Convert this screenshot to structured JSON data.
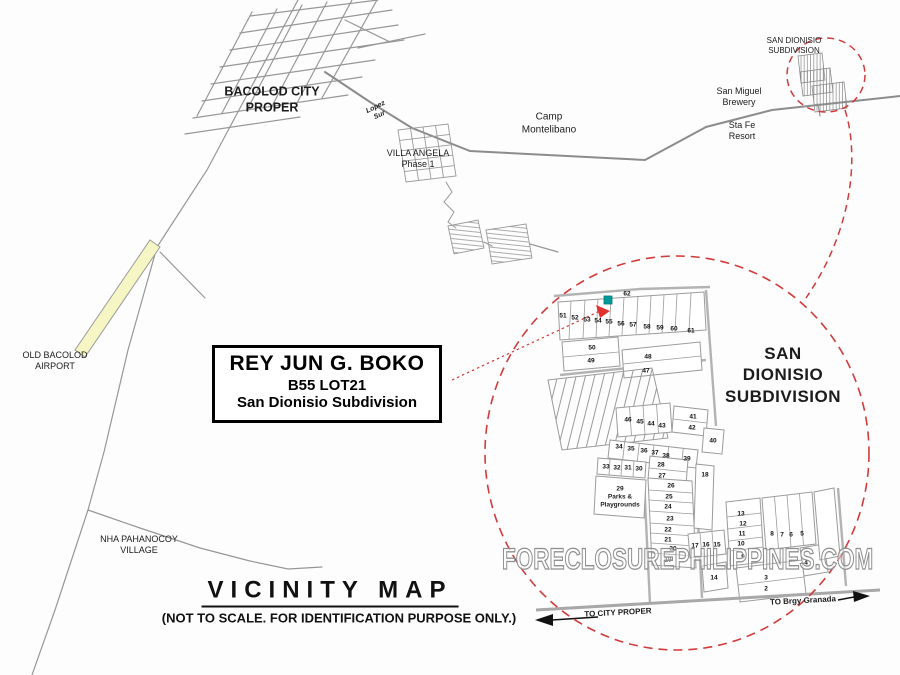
{
  "map": {
    "title": "VICINITY MAP",
    "subtitle": "(NOT TO SCALE. FOR IDENTIFICATION PURPOSE ONLY.)",
    "watermark": "FORECLOSUREPHILIPPINES.COM",
    "property_box": {
      "owner": "REY JUN G. BOKO",
      "lot": "B55 LOT21",
      "subdivision": "San Dionisio Subdivision"
    },
    "places": {
      "bacolod_city": "BACOLOD CITY\nPROPER",
      "lopez_sur": "Lopez\nSur",
      "villa_angela": "VILLA ANGELA\nPhase 1",
      "camp_montelibano": "Camp\nMontelibano",
      "san_dionisio_small": "SAN DIONISIO\nSUBDIVISION",
      "san_miguel_brewery": "San Miguel\nBrewery",
      "sta_fe_resort": "Sta Fe\nResort",
      "old_bacolod_airport": "OLD BACOLOD\nAIRPORT",
      "nha_pahanocoy": "NHA PAHANOCOY\nVILLAGE",
      "san_dionisio_big": "SAN DIONISIO\nSUBDIVISION"
    },
    "directions": {
      "to_city_proper": "TO CITY PROPER",
      "to_brgy_granada": "TO Brgy Granada"
    },
    "detail": {
      "parks_block": "29\nParks &\nPlaygrounds",
      "lots": [
        {
          "n": "51",
          "x": 563,
          "y": 316
        },
        {
          "n": "52",
          "x": 575,
          "y": 318
        },
        {
          "n": "53",
          "x": 587,
          "y": 320
        },
        {
          "n": "54",
          "x": 598,
          "y": 321
        },
        {
          "n": "55",
          "x": 609,
          "y": 322
        },
        {
          "n": "56",
          "x": 621,
          "y": 324
        },
        {
          "n": "57",
          "x": 633,
          "y": 325
        },
        {
          "n": "58",
          "x": 647,
          "y": 327
        },
        {
          "n": "59",
          "x": 660,
          "y": 328
        },
        {
          "n": "60",
          "x": 674,
          "y": 329
        },
        {
          "n": "61",
          "x": 691,
          "y": 331
        },
        {
          "n": "62",
          "x": 627,
          "y": 294
        },
        {
          "n": "50",
          "x": 592,
          "y": 348
        },
        {
          "n": "49",
          "x": 591,
          "y": 361
        },
        {
          "n": "48",
          "x": 648,
          "y": 357
        },
        {
          "n": "47",
          "x": 646,
          "y": 371
        },
        {
          "n": "46",
          "x": 628,
          "y": 420
        },
        {
          "n": "45",
          "x": 640,
          "y": 422
        },
        {
          "n": "44",
          "x": 651,
          "y": 424
        },
        {
          "n": "43",
          "x": 662,
          "y": 426
        },
        {
          "n": "42",
          "x": 692,
          "y": 428
        },
        {
          "n": "41",
          "x": 693,
          "y": 417
        },
        {
          "n": "40",
          "x": 713,
          "y": 441
        },
        {
          "n": "34",
          "x": 619,
          "y": 447
        },
        {
          "n": "35",
          "x": 631,
          "y": 449
        },
        {
          "n": "36",
          "x": 644,
          "y": 451
        },
        {
          "n": "37",
          "x": 655,
          "y": 453
        },
        {
          "n": "38",
          "x": 666,
          "y": 456
        },
        {
          "n": "39",
          "x": 687,
          "y": 459
        },
        {
          "n": "33",
          "x": 606,
          "y": 467
        },
        {
          "n": "32",
          "x": 617,
          "y": 468
        },
        {
          "n": "31",
          "x": 628,
          "y": 468
        },
        {
          "n": "30",
          "x": 639,
          "y": 469
        },
        {
          "n": "28",
          "x": 661,
          "y": 465
        },
        {
          "n": "27",
          "x": 662,
          "y": 476
        },
        {
          "n": "18",
          "x": 705,
          "y": 475
        },
        {
          "n": "26",
          "x": 671,
          "y": 486
        },
        {
          "n": "25",
          "x": 669,
          "y": 497
        },
        {
          "n": "24",
          "x": 668,
          "y": 507
        },
        {
          "n": "23",
          "x": 670,
          "y": 519
        },
        {
          "n": "22",
          "x": 668,
          "y": 530
        },
        {
          "n": "21",
          "x": 668,
          "y": 540
        },
        {
          "n": "20",
          "x": 673,
          "y": 549
        },
        {
          "n": "19",
          "x": 668,
          "y": 560
        },
        {
          "n": "17",
          "x": 695,
          "y": 546
        },
        {
          "n": "16",
          "x": 706,
          "y": 545
        },
        {
          "n": "15",
          "x": 717,
          "y": 545
        },
        {
          "n": "14",
          "x": 714,
          "y": 578
        },
        {
          "n": "13",
          "x": 741,
          "y": 514
        },
        {
          "n": "12",
          "x": 743,
          "y": 524
        },
        {
          "n": "11",
          "x": 742,
          "y": 534
        },
        {
          "n": "10",
          "x": 741,
          "y": 544
        },
        {
          "n": "9",
          "x": 743,
          "y": 557
        },
        {
          "n": "8",
          "x": 772,
          "y": 534
        },
        {
          "n": "7",
          "x": 782,
          "y": 535
        },
        {
          "n": "6",
          "x": 791,
          "y": 535
        },
        {
          "n": "5",
          "x": 802,
          "y": 534
        },
        {
          "n": "4",
          "x": 806,
          "y": 563
        },
        {
          "n": "3",
          "x": 766,
          "y": 578
        },
        {
          "n": "2",
          "x": 766,
          "y": 589
        }
      ]
    },
    "colors": {
      "circle_red": "#d23b3b",
      "marker_teal": "#00999a",
      "runway_yellow": "#f6f6c5",
      "road_gray": "#979797"
    }
  }
}
